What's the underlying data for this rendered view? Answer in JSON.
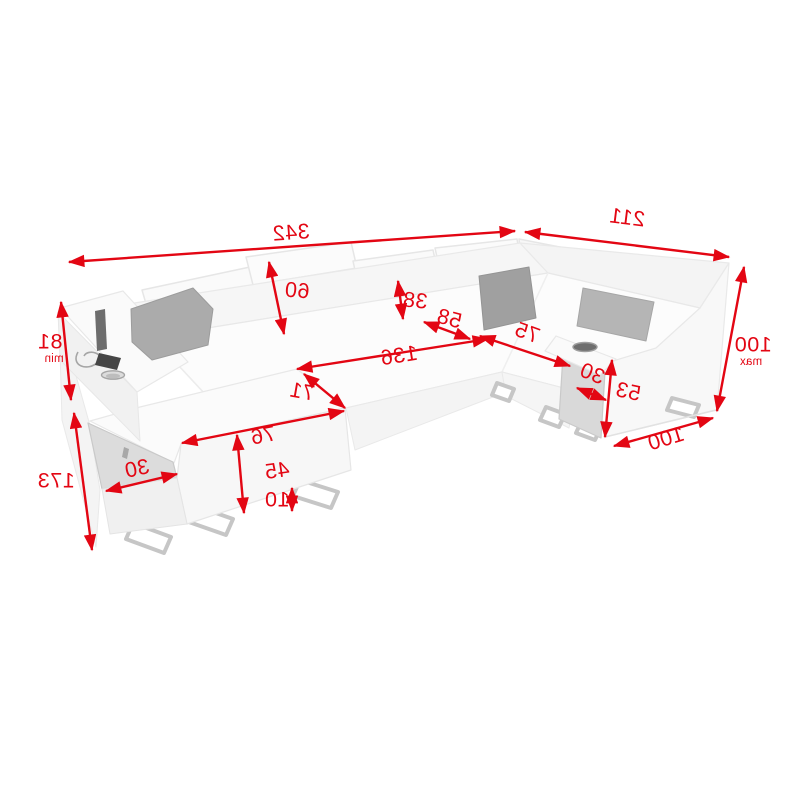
{
  "diagram": {
    "type": "furniture-dimension-diagram",
    "subject": "U-shaped corner sofa bed with measurement arrows (mirrored labels)",
    "accent_color": "#e30613",
    "background_color": "#ffffff",
    "text_mirrored": true
  },
  "measurements": {
    "total_width": "342",
    "right_side_width": "211",
    "overall_height_max": "100",
    "overall_height_max_label": "max",
    "armrest_height_min": "81",
    "armrest_height_min_label": "min",
    "total_depth": "173",
    "headrest_height": "60",
    "backrest_height": "38",
    "corner_seat_depth": "58",
    "sleeping_length": "136",
    "sleeping_width": "71",
    "chaise_front_width": "76",
    "seat_box_height": "45",
    "left_shelf_depth": "30",
    "leg_height": "10",
    "right_seat_width": "75",
    "right_shelf_depth": "30",
    "right_armrest_height": "53",
    "right_section_depth": "100"
  }
}
